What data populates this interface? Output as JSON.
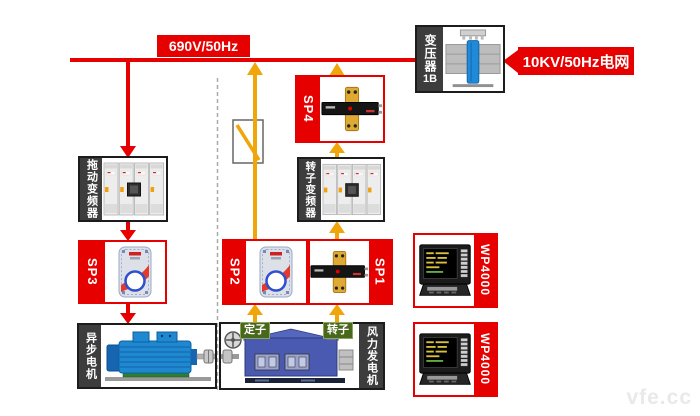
{
  "diagram": {
    "bus_label": "690V/50Hz",
    "grid_label": "10KV/50Hz电网",
    "transformer": {
      "name": "变压器",
      "id": "1B"
    },
    "boxes": {
      "drive_inverter": "拖动变频器",
      "rotor_inverter": "转子变频器",
      "async_motor": "异步电机",
      "wind_generator": "风力发电机"
    },
    "sensors": {
      "sp1": "SP1",
      "sp2": "SP2",
      "sp3": "SP3",
      "sp4": "SP4"
    },
    "instruments": {
      "top": "WP4000",
      "bottom": "WP4000"
    },
    "generator_terminals": {
      "stator": "定子",
      "rotor": "转子"
    },
    "watermark": "vfe.cc",
    "colors": {
      "bus_red": "#e60000",
      "arrow_yellow": "#f0a50a",
      "strip_dark": "#3d3d3d",
      "terminal_green": "#4a681c"
    }
  }
}
